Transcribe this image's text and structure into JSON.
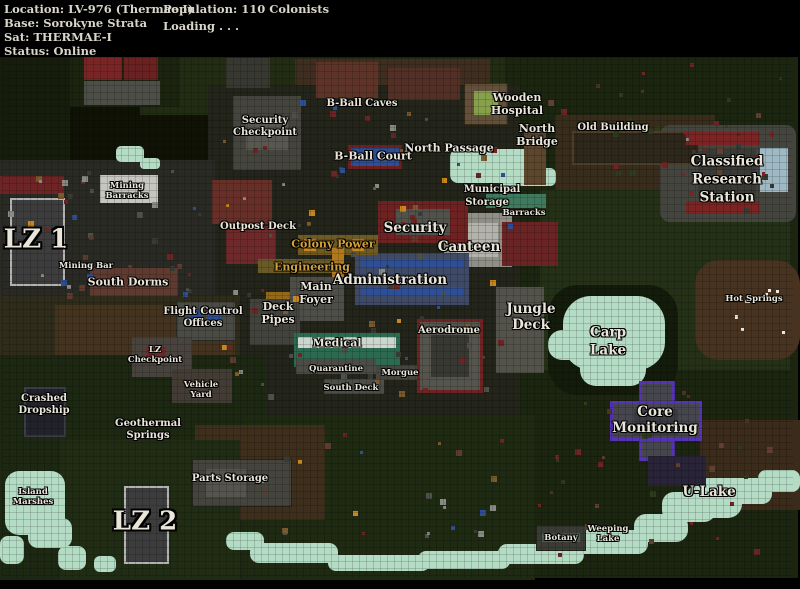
{
  "header": {
    "location": "Location: LV-976 (Thermae I)",
    "base": "Base: Sorokyne Strata",
    "sat": "Sat: THERMAE-I",
    "status": "Status: Online",
    "population": "Population: 110 Colonists",
    "loading": "Loading . . ."
  },
  "map": {
    "label_default_color": "#e9e5d9",
    "palette": {
      "jungle": "#1b2510",
      "jungle_light": "#243117",
      "dirt": "#44331e",
      "water": "#b4dcc4",
      "structure_gray": "#45453e",
      "landing_pad": "#3d3d3d",
      "accent_red": "#6e2222",
      "accent_blue": "#2e4e96",
      "accent_yellow": "#c8861e",
      "accent_teal": "#2c6a52",
      "accent_purple": "#5633b4",
      "label_yellow": "#d2a23a"
    },
    "labels": [
      {
        "id": "security-checkpoint",
        "lines": [
          "Security",
          "Checkpoint"
        ],
        "x": 265,
        "y": 127,
        "size": "s"
      },
      {
        "id": "b-ball-caves",
        "lines": [
          "B-Ball Caves"
        ],
        "x": 362,
        "y": 104,
        "size": "s"
      },
      {
        "id": "b-ball-court",
        "lines": [
          "B-Ball Court"
        ],
        "x": 373,
        "y": 156,
        "size": "r"
      },
      {
        "id": "north-passage",
        "lines": [
          "North Passage"
        ],
        "x": 449,
        "y": 148,
        "size": "r"
      },
      {
        "id": "wooden-hospital",
        "lines": [
          "Wooden",
          "Hospital"
        ],
        "x": 517,
        "y": 104,
        "size": "r"
      },
      {
        "id": "north-bridge",
        "lines": [
          "North",
          "Bridge"
        ],
        "x": 537,
        "y": 135,
        "size": "r"
      },
      {
        "id": "old-building",
        "lines": [
          "Old Building"
        ],
        "x": 613,
        "y": 128,
        "size": "s"
      },
      {
        "id": "classified-research-station",
        "lines": [
          "Classified",
          "Research",
          "Station"
        ],
        "x": 727,
        "y": 180,
        "size": "m",
        "lh": 1.32
      },
      {
        "id": "lz-1",
        "lines": [
          "LZ 1"
        ],
        "x": 36,
        "y": 240,
        "size": "xl"
      },
      {
        "id": "mining-barracks",
        "lines": [
          "Mining",
          "Barracks"
        ],
        "x": 127,
        "y": 191,
        "size": "xs"
      },
      {
        "id": "outpost-deck",
        "lines": [
          "Outpost Deck"
        ],
        "x": 258,
        "y": 227,
        "size": "s"
      },
      {
        "id": "colony-power",
        "lines": [
          "Colony Power"
        ],
        "x": 333,
        "y": 244,
        "size": "r",
        "color": "#d2a23a"
      },
      {
        "id": "engineering",
        "lines": [
          "Engineering"
        ],
        "x": 312,
        "y": 267,
        "size": "r",
        "color": "#d2a23a"
      },
      {
        "id": "security",
        "lines": [
          "Security"
        ],
        "x": 415,
        "y": 228,
        "size": "m"
      },
      {
        "id": "municipal",
        "lines": [
          "Municipal"
        ],
        "x": 492,
        "y": 190,
        "size": "s"
      },
      {
        "id": "storage",
        "lines": [
          "Storage"
        ],
        "x": 487,
        "y": 203,
        "size": "s"
      },
      {
        "id": "barracks",
        "lines": [
          "Barracks"
        ],
        "x": 524,
        "y": 213,
        "size": "xs"
      },
      {
        "id": "canteen",
        "lines": [
          "Canteen"
        ],
        "x": 469,
        "y": 247,
        "size": "m"
      },
      {
        "id": "administration",
        "lines": [
          "Administration"
        ],
        "x": 390,
        "y": 280,
        "size": "m"
      },
      {
        "id": "main-foyer",
        "lines": [
          "Main",
          "Foyer"
        ],
        "x": 316,
        "y": 293,
        "size": "r"
      },
      {
        "id": "deck-pipes",
        "lines": [
          "Deck",
          "Pipes"
        ],
        "x": 278,
        "y": 313,
        "size": "r"
      },
      {
        "id": "mining-bar",
        "lines": [
          "Mining Bar"
        ],
        "x": 86,
        "y": 266,
        "size": "xs"
      },
      {
        "id": "south-dorms",
        "lines": [
          "South Dorms"
        ],
        "x": 128,
        "y": 282,
        "size": "r"
      },
      {
        "id": "flight-control-offices",
        "lines": [
          "Flight Control",
          "Offices"
        ],
        "x": 203,
        "y": 318,
        "size": "s"
      },
      {
        "id": "lz-checkpoint",
        "lines": [
          "LZ",
          "Checkpoint"
        ],
        "x": 155,
        "y": 355,
        "size": "xs"
      },
      {
        "id": "vehicle-yard",
        "lines": [
          "Vehicle",
          "Yard"
        ],
        "x": 201,
        "y": 390,
        "size": "xs"
      },
      {
        "id": "medical",
        "lines": [
          "Medical"
        ],
        "x": 337,
        "y": 343,
        "size": "r"
      },
      {
        "id": "quarantine",
        "lines": [
          "Quarantine"
        ],
        "x": 336,
        "y": 369,
        "size": "xs"
      },
      {
        "id": "morgue",
        "lines": [
          "Morgue"
        ],
        "x": 400,
        "y": 373,
        "size": "xs"
      },
      {
        "id": "south-deck",
        "lines": [
          "South Deck"
        ],
        "x": 351,
        "y": 388,
        "size": "xs"
      },
      {
        "id": "aerodrome",
        "lines": [
          "Aerodrome"
        ],
        "x": 449,
        "y": 331,
        "size": "s"
      },
      {
        "id": "jungle-deck",
        "lines": [
          "Jungle",
          "Deck"
        ],
        "x": 531,
        "y": 317,
        "size": "m"
      },
      {
        "id": "carp-lake",
        "lines": [
          "Carp",
          "Lake"
        ],
        "x": 608,
        "y": 342,
        "size": "m",
        "lh": 1.3
      },
      {
        "id": "hot-springs",
        "lines": [
          "Hot Springs"
        ],
        "x": 754,
        "y": 299,
        "size": "xs"
      },
      {
        "id": "crashed-dropship",
        "lines": [
          "Crashed",
          "Dropship"
        ],
        "x": 44,
        "y": 405,
        "size": "s"
      },
      {
        "id": "geothermal-springs",
        "lines": [
          "Geothermal",
          "Springs"
        ],
        "x": 148,
        "y": 430,
        "size": "s"
      },
      {
        "id": "parts-storage",
        "lines": [
          "Parts Storage"
        ],
        "x": 230,
        "y": 479,
        "size": "s"
      },
      {
        "id": "lz-2",
        "lines": [
          "LZ 2"
        ],
        "x": 145,
        "y": 522,
        "size": "xl"
      },
      {
        "id": "core-monitoring",
        "lines": [
          "Core",
          "Monitoring"
        ],
        "x": 655,
        "y": 420,
        "size": "m"
      },
      {
        "id": "u-lake",
        "lines": [
          "U-Lake"
        ],
        "x": 709,
        "y": 492,
        "size": "m"
      },
      {
        "id": "botany",
        "lines": [
          "Botany"
        ],
        "x": 561,
        "y": 538,
        "size": "xs"
      },
      {
        "id": "weeping-lake",
        "lines": [
          "Weeping",
          "Lake"
        ],
        "x": 608,
        "y": 534,
        "size": "xs"
      },
      {
        "id": "island-marshes",
        "lines": [
          "Island",
          "Marshes"
        ],
        "x": 33,
        "y": 497,
        "size": "xs"
      }
    ]
  }
}
